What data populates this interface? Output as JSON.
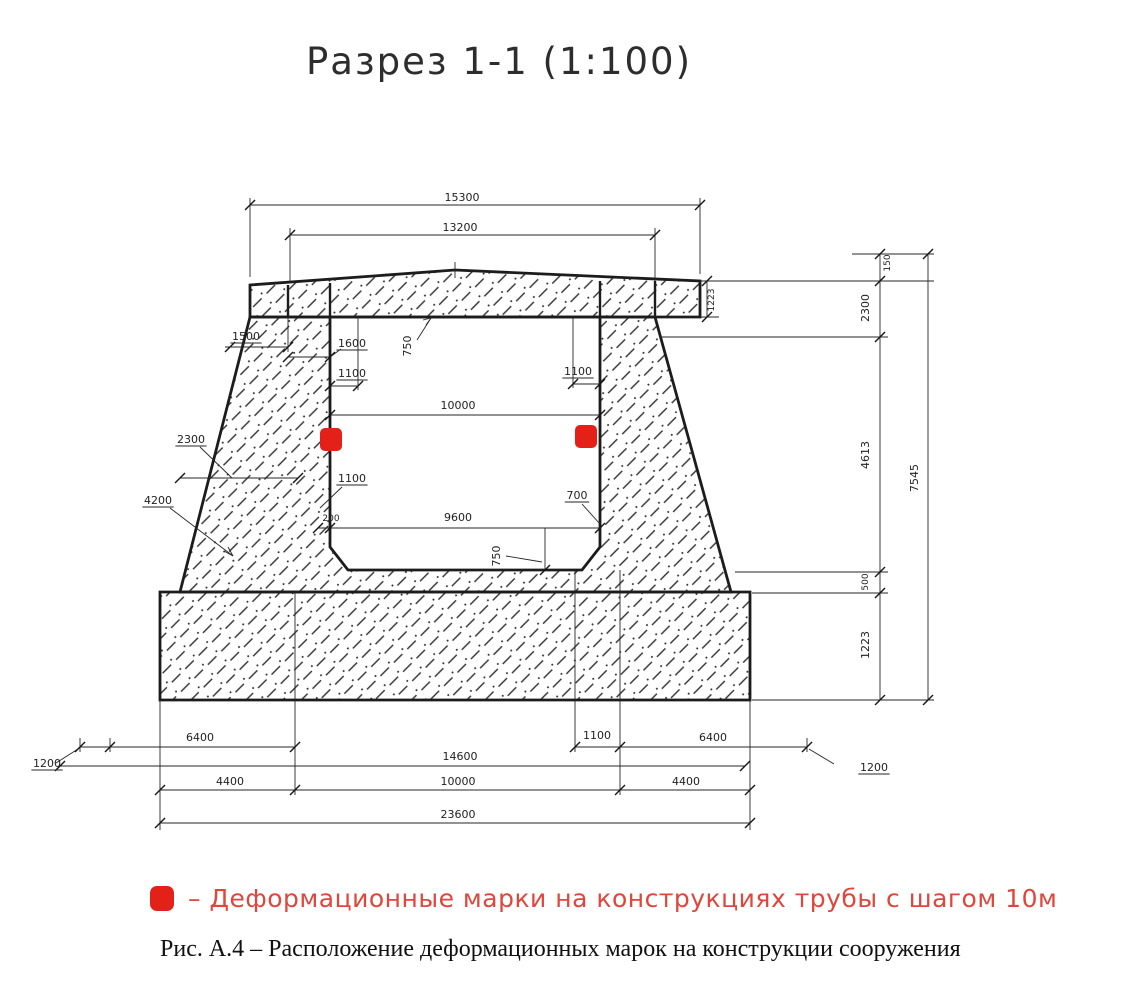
{
  "title": "Разрез 1-1 (1:100)",
  "legend": {
    "marker_color": "#e32119",
    "text_color": "#e0463c",
    "text": "–  Деформационные марки на конструкциях трубы с шагом 10м"
  },
  "caption": "Рис. А.4 – Расположение деформационных марок на конструкции сооружения",
  "drawing": {
    "line_color": "#262626",
    "label_color": "#1f1f1f",
    "marker_color": "#e32119",
    "marker_size": 22,
    "hatch_regions": [
      {
        "name": "top-slab",
        "path": "M250,285 L455,270 L700,281 L700,317 L250,317 Z"
      },
      {
        "name": "body-walls",
        "path": "M250,317 L655,317 L731,592 L180,592 Z M330,317 L600,317 L600,547 L582,570 L348,570 L330,547 Z",
        "evenodd": true
      },
      {
        "name": "footing-slab",
        "path": "M160,592 L750,592 L750,700 L160,700 Z"
      }
    ],
    "bold_lines": [
      [
        288,
        285,
        288,
        317
      ],
      [
        330,
        283,
        330,
        317
      ],
      [
        600,
        281,
        600,
        317
      ],
      [
        655,
        281,
        655,
        317
      ]
    ],
    "thin_lines": [
      [
        250,
        277,
        250,
        198
      ],
      [
        700,
        274,
        700,
        198
      ],
      [
        250,
        205,
        700,
        205
      ],
      [
        290,
        283,
        290,
        228
      ],
      [
        655,
        281,
        655,
        228
      ],
      [
        290,
        235,
        655,
        235
      ],
      [
        455,
        262,
        455,
        278
      ],
      [
        700,
        281,
        934,
        281
      ],
      [
        852,
        254,
        934,
        254
      ],
      [
        707,
        281,
        707,
        317
      ],
      [
        700,
        317,
        719,
        317
      ],
      [
        660,
        337,
        888,
        337
      ],
      [
        735,
        572,
        888,
        572
      ],
      [
        752,
        593,
        888,
        593
      ],
      [
        752,
        700,
        934,
        700
      ],
      [
        880,
        254,
        880,
        700
      ],
      [
        928,
        254,
        928,
        700
      ],
      [
        288,
        317,
        288,
        352
      ],
      [
        225,
        347,
        288,
        347
      ],
      [
        288,
        357,
        330,
        357
      ],
      [
        330,
        357,
        341,
        349
      ],
      [
        358,
        317,
        358,
        390
      ],
      [
        330,
        386,
        358,
        386
      ],
      [
        573,
        317,
        573,
        388
      ],
      [
        573,
        384,
        600,
        384
      ],
      [
        417,
        340,
        431,
        318
      ],
      [
        431,
        318,
        423,
        320
      ],
      [
        431,
        318,
        426,
        325
      ],
      [
        330,
        415,
        600,
        415
      ],
      [
        180,
        478,
        298,
        478
      ],
      [
        200,
        447,
        232,
        478
      ],
      [
        170,
        508,
        233,
        556
      ],
      [
        233,
        556,
        224,
        551
      ],
      [
        233,
        556,
        228,
        547
      ],
      [
        342,
        487,
        320,
        508
      ],
      [
        318,
        528,
        600,
        528
      ],
      [
        545,
        528,
        545,
        570
      ],
      [
        506,
        556,
        542,
        562
      ],
      [
        582,
        504,
        600,
        524
      ],
      [
        80,
        738,
        80,
        752
      ],
      [
        110,
        738,
        110,
        752
      ],
      [
        160,
        700,
        160,
        830
      ],
      [
        750,
        700,
        750,
        830
      ],
      [
        295,
        592,
        295,
        795
      ],
      [
        575,
        570,
        575,
        752
      ],
      [
        620,
        570,
        620,
        795
      ],
      [
        807,
        738,
        807,
        752
      ],
      [
        80,
        747,
        295,
        747
      ],
      [
        575,
        747,
        807,
        747
      ],
      [
        78,
        749,
        56,
        763
      ],
      [
        809,
        749,
        834,
        764
      ],
      [
        60,
        766,
        745,
        766
      ],
      [
        160,
        790,
        750,
        790
      ],
      [
        160,
        823,
        750,
        823
      ]
    ],
    "ticks": [
      [
        250,
        205
      ],
      [
        700,
        205
      ],
      [
        290,
        235
      ],
      [
        655,
        235
      ],
      [
        230,
        347
      ],
      [
        288,
        347
      ],
      [
        288,
        357
      ],
      [
        330,
        357
      ],
      [
        330,
        386
      ],
      [
        358,
        386
      ],
      [
        573,
        384
      ],
      [
        600,
        384
      ],
      [
        330,
        415
      ],
      [
        600,
        415
      ],
      [
        180,
        478
      ],
      [
        298,
        478
      ],
      [
        318,
        528
      ],
      [
        330,
        528
      ],
      [
        600,
        528
      ],
      [
        545,
        570
      ],
      [
        707,
        281
      ],
      [
        707,
        317
      ],
      [
        880,
        254
      ],
      [
        880,
        281
      ],
      [
        880,
        337
      ],
      [
        880,
        572
      ],
      [
        880,
        593
      ],
      [
        880,
        700
      ],
      [
        928,
        254
      ],
      [
        928,
        700
      ],
      [
        80,
        747
      ],
      [
        110,
        747
      ],
      [
        295,
        747
      ],
      [
        575,
        747
      ],
      [
        620,
        747
      ],
      [
        807,
        747
      ],
      [
        60,
        766
      ],
      [
        745,
        766
      ],
      [
        160,
        790
      ],
      [
        295,
        790
      ],
      [
        620,
        790
      ],
      [
        750,
        790
      ],
      [
        160,
        823
      ],
      [
        750,
        823
      ]
    ],
    "labels": [
      {
        "t": "15300",
        "x": 462,
        "y": 201
      },
      {
        "t": "13200",
        "x": 460,
        "y": 231
      },
      {
        "t": "1500",
        "x": 246,
        "y": 340,
        "ul": 1
      },
      {
        "t": "1600",
        "x": 352,
        "y": 347,
        "ul": 1
      },
      {
        "t": "750",
        "x": 411,
        "y": 346,
        "r": -90
      },
      {
        "t": "1100",
        "x": 352,
        "y": 377,
        "ul": 1
      },
      {
        "t": "1100",
        "x": 578,
        "y": 375,
        "ul": 1
      },
      {
        "t": "10000",
        "x": 458,
        "y": 409
      },
      {
        "t": "2300",
        "x": 191,
        "y": 443,
        "ul": 1
      },
      {
        "t": "4200",
        "x": 158,
        "y": 504,
        "ul": 1
      },
      {
        "t": "1100",
        "x": 352,
        "y": 482,
        "ul": 1
      },
      {
        "t": "200",
        "x": 331,
        "y": 521,
        "s": 9
      },
      {
        "t": "9600",
        "x": 458,
        "y": 521
      },
      {
        "t": "700",
        "x": 577,
        "y": 499,
        "ul": 1
      },
      {
        "t": "750",
        "x": 500,
        "y": 556,
        "r": -90
      },
      {
        "t": "1200",
        "x": 47,
        "y": 767,
        "ul": 1
      },
      {
        "t": "6400",
        "x": 200,
        "y": 741
      },
      {
        "t": "1100",
        "x": 597,
        "y": 739
      },
      {
        "t": "6400",
        "x": 713,
        "y": 741
      },
      {
        "t": "1200",
        "x": 874,
        "y": 771,
        "ul": 1
      },
      {
        "t": "14600",
        "x": 460,
        "y": 760
      },
      {
        "t": "4400",
        "x": 230,
        "y": 785
      },
      {
        "t": "10000",
        "x": 458,
        "y": 785
      },
      {
        "t": "4400",
        "x": 686,
        "y": 785
      },
      {
        "t": "23600",
        "x": 458,
        "y": 818
      },
      {
        "t": "1223",
        "x": 714,
        "y": 300,
        "r": -90,
        "s": 9
      },
      {
        "t": "150",
        "x": 890,
        "y": 263,
        "r": -90,
        "s": 9
      },
      {
        "t": "2300",
        "x": 869,
        "y": 308,
        "r": -90
      },
      {
        "t": "4613",
        "x": 869,
        "y": 455,
        "r": -90
      },
      {
        "t": "500",
        "x": 868,
        "y": 582,
        "r": -90,
        "s": 9
      },
      {
        "t": "1223",
        "x": 869,
        "y": 645,
        "r": -90
      },
      {
        "t": "7545",
        "x": 918,
        "y": 478,
        "r": -90
      }
    ],
    "markers": [
      {
        "x": 320,
        "y": 428
      },
      {
        "x": 575,
        "y": 425
      }
    ]
  }
}
